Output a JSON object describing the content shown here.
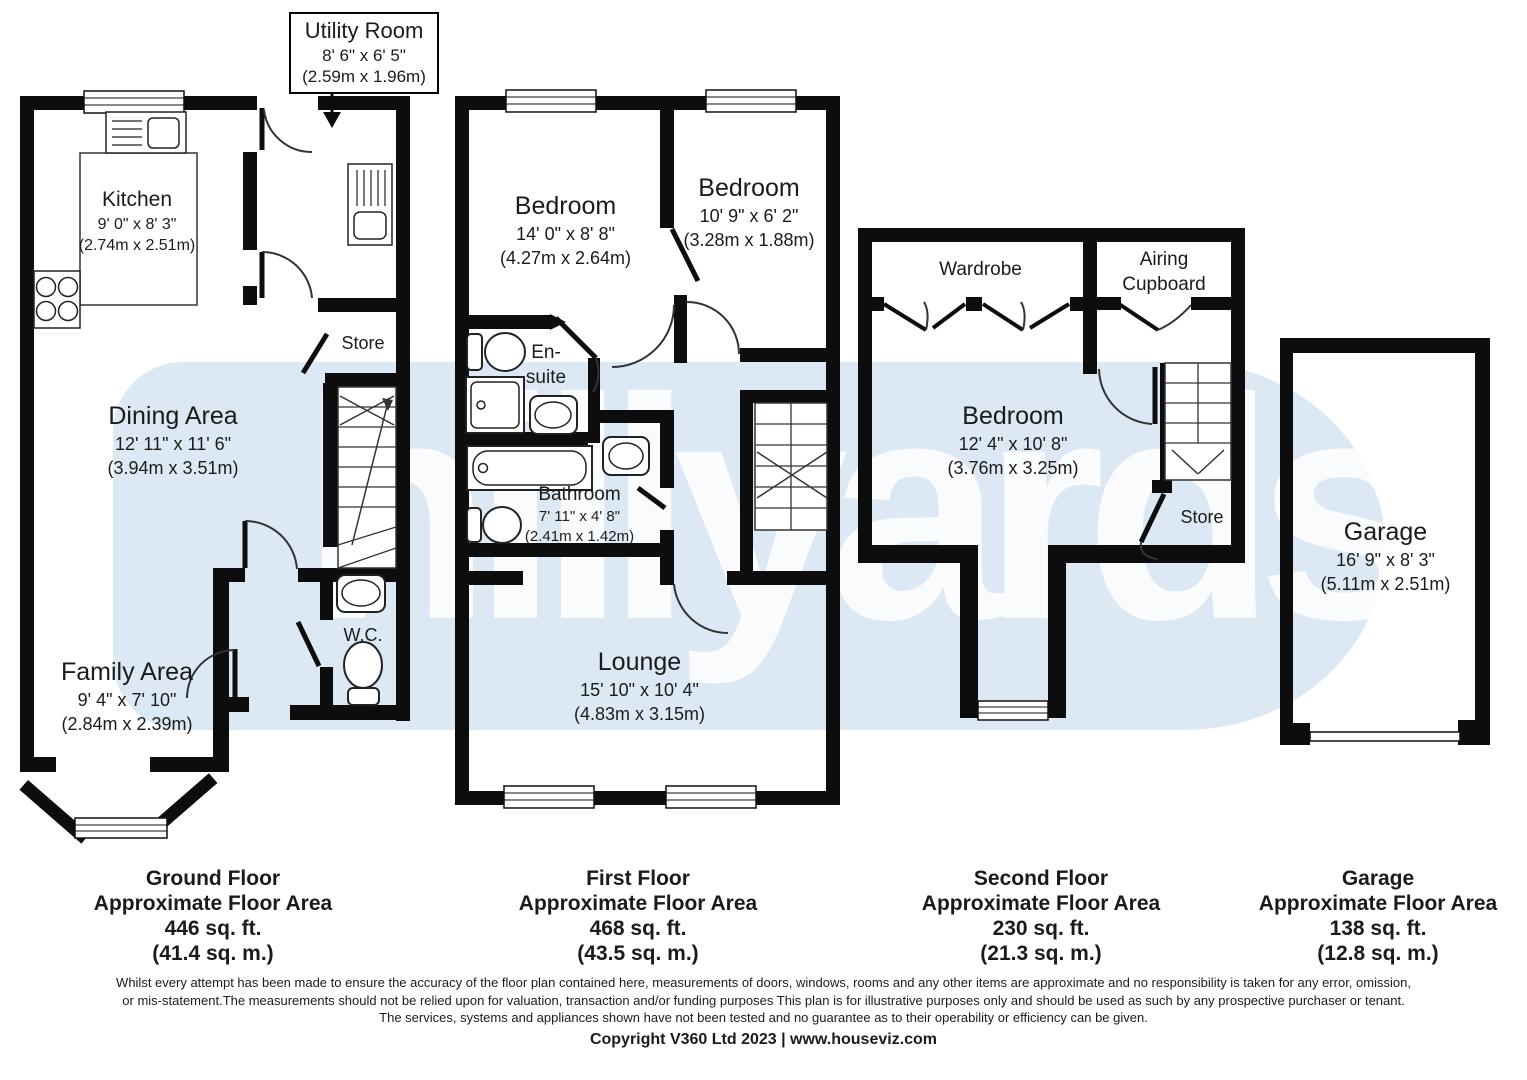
{
  "watermark": {
    "text": "hillyards."
  },
  "callout": {
    "title": "Utility Room",
    "imperial": "8' 6\" x 6' 5\"",
    "metric": "(2.59m x 1.96m)"
  },
  "ground_floor": {
    "kitchen": {
      "name": "Kitchen",
      "imperial": "9' 0\" x 8' 3\"",
      "metric": "(2.74m x 2.51m)"
    },
    "dining": {
      "name": "Dining Area",
      "imperial": "12' 11\" x 11' 6\"",
      "metric": "(3.94m x 3.51m)"
    },
    "family": {
      "name": "Family Area",
      "imperial": "9' 4\" x 7' 10\"",
      "metric": "(2.84m x 2.39m)"
    },
    "store": {
      "name": "Store"
    },
    "wc": {
      "name": "W.C."
    }
  },
  "first_floor": {
    "bedroom1": {
      "name": "Bedroom",
      "imperial": "14' 0\" x 8' 8\"",
      "metric": "(4.27m x 2.64m)"
    },
    "bedroom2": {
      "name": "Bedroom",
      "imperial": "10' 9\" x 6' 2\"",
      "metric": "(3.28m x 1.88m)"
    },
    "ensuite": {
      "name": "En-\nsuite"
    },
    "bathroom": {
      "name": "Bathroom",
      "imperial": "7' 11\" x 4' 8\"",
      "metric": "(2.41m x 1.42m)"
    },
    "lounge": {
      "name": "Lounge",
      "imperial": "15' 10\" x 10' 4\"",
      "metric": "(4.83m x 3.15m)"
    }
  },
  "second_floor": {
    "wardrobe": {
      "name": "Wardrobe"
    },
    "airing": {
      "name": "Airing\nCupboard"
    },
    "bedroom": {
      "name": "Bedroom",
      "imperial": "12' 4\" x 10' 8\"",
      "metric": "(3.76m x 3.25m)"
    },
    "store": {
      "name": "Store"
    }
  },
  "garage": {
    "name": "Garage",
    "imperial": "16' 9\" x 8' 3\"",
    "metric": "(5.11m x 2.51m)"
  },
  "summaries": [
    {
      "title": "Ground Floor",
      "subtitle": "Approximate Floor Area",
      "imperial": "446 sq. ft.",
      "metric": "(41.4 sq. m.)"
    },
    {
      "title": "First Floor",
      "subtitle": "Approximate Floor Area",
      "imperial": "468 sq. ft.",
      "metric": "(43.5 sq. m.)"
    },
    {
      "title": "Second Floor",
      "subtitle": "Approximate Floor Area",
      "imperial": "230 sq. ft.",
      "metric": "(21.3 sq. m.)"
    },
    {
      "title": "Garage",
      "subtitle": "Approximate Floor Area",
      "imperial": "138 sq. ft.",
      "metric": "(12.8 sq. m.)"
    }
  ],
  "footer": {
    "line1": "Whilst every attempt has been made to ensure the accuracy of the floor plan contained here, measurements of doors, windows, rooms and any other items are approximate and no responsibility is taken for any error, omission,",
    "line2": "or mis-statement.The measurements should not be relied upon for valuation, transaction and/or funding purposes This plan is for illustrative purposes only and should be used as such by any prospective purchaser or tenant.",
    "line3": "The services, systems and appliances shown have not been tested and no guarantee as to their operability or efficiency can be given.",
    "copyright": "Copyright V360 Ltd 2023 | www.houseviz.com"
  }
}
